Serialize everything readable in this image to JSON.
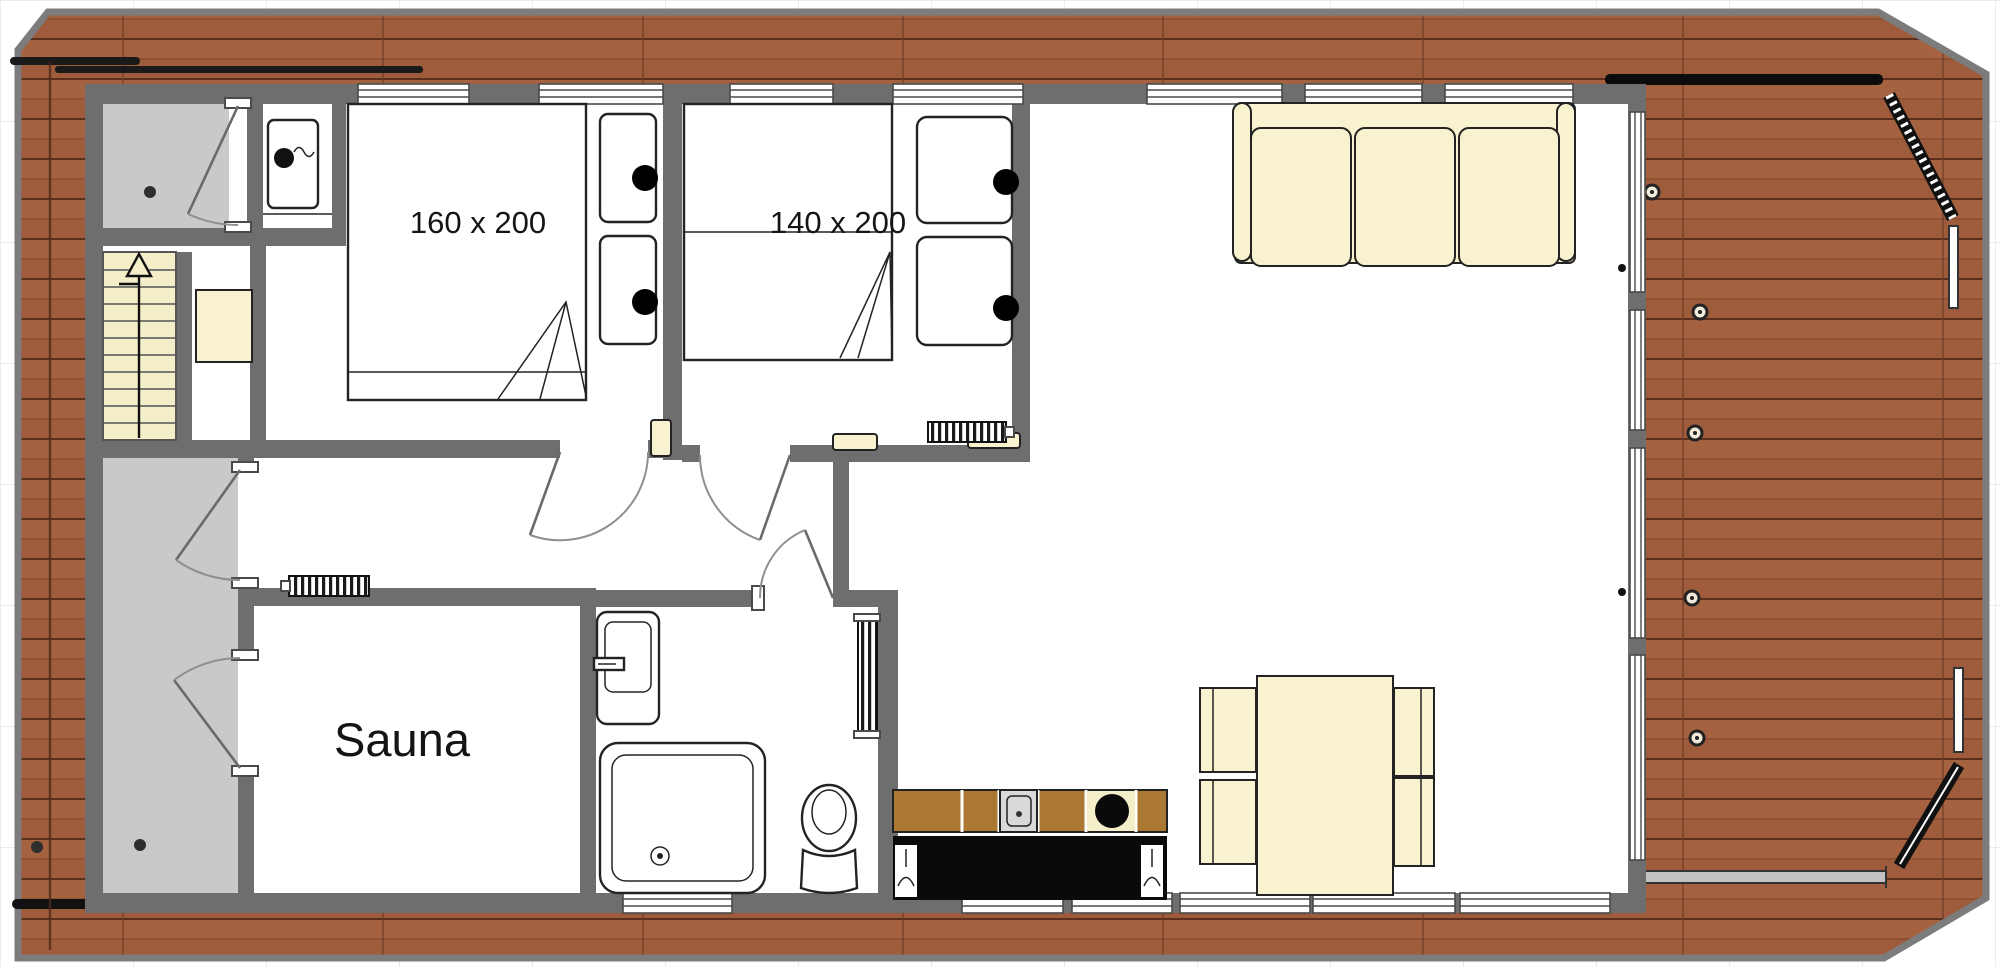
{
  "plan": {
    "type": "houseboat-floor-plan",
    "labels": {
      "bed_large": "160 x 200",
      "bed_small": "140 x 200",
      "sauna": "Sauna"
    },
    "colors": {
      "deck_wood": "#9e5c3c",
      "deck_plank_seam": "#5c2f1d",
      "walls": "#6e6e6e",
      "gray_floor": "#c9c9c9",
      "furniture_cream": "#f8f2cf",
      "stairs_cream": "#f5efc9",
      "counter_black": "#0a0a0a",
      "cabinet_tan": "#aa7833",
      "hull_outline": "#7c7c7c"
    },
    "rooms_depicted": [
      "entry-vestibule",
      "technical-closet",
      "bedroom-160x200",
      "bedroom-140x200",
      "hallway",
      "sauna",
      "bathroom",
      "living-room",
      "kitchen",
      "stairs",
      "side-corridor",
      "wrap-around-deck"
    ]
  }
}
